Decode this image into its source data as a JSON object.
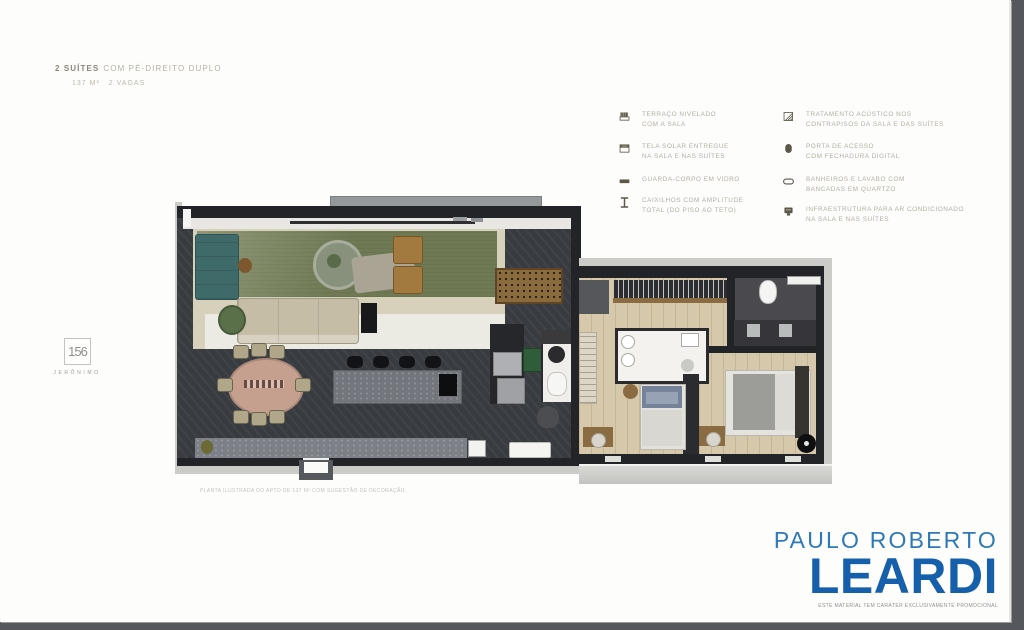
{
  "header": {
    "title_bold": "2 SUÍTES",
    "title_rest": "COM PÉ-DIREITO DUPLO",
    "area": "137 M²",
    "parking": "2 VAGAS"
  },
  "legend": {
    "left": [
      {
        "icon": "terrace-icon",
        "line1": "TERRAÇO NIVELADO",
        "line2": "COM A SALA"
      },
      {
        "icon": "solar-screen-icon",
        "line1": "TELA SOLAR ENTREGUE",
        "line2": "NA SALA E NAS SUÍTES"
      },
      {
        "icon": "glass-railing-icon",
        "line1": "GUARDA-CORPO EM VIDRO",
        "line2": ""
      },
      {
        "icon": "full-height-frame-icon",
        "line1": "CAIXILHOS COM AMPLITUDE",
        "line2": "TOTAL (DO PISO AO TETO)"
      }
    ],
    "right": [
      {
        "icon": "acoustic-floor-icon",
        "line1": "TRATAMENTO ACÚSTICO NOS",
        "line2": "CONTRAPISOS DA SALA E DAS SUÍTES"
      },
      {
        "icon": "digital-lock-icon",
        "line1": "PORTA DE ACESSO",
        "line2": "COM FECHADURA DIGITAL"
      },
      {
        "icon": "quartz-countertop-icon",
        "line1": "BANHEIROS E LAVABO COM",
        "line2": "BANCADAS EM QUARTZO"
      },
      {
        "icon": "air-conditioning-icon",
        "line1": "INFRAESTRUTURA PARA AR CONDICIONADO",
        "line2": "NA SALA E NAS SUÍTES"
      }
    ]
  },
  "building_logo": {
    "number": "156",
    "name": "JERÔNIMO"
  },
  "floorplan": {
    "caption": "PLANTA ILUSTRADA DO APTO DE 137 M² COM SUGESTÃO DE DECORAÇÃO."
  },
  "brand": {
    "line1": "PAULO ROBERTO",
    "line2": "LEARDI",
    "tagline": "ESTE MATERIAL TEM CARÁTER EXCLUSIVAMENTE PROMOCIONAL"
  },
  "colors": {
    "brand_blue": "#1660ab",
    "brand_blue_light": "#2e79b7",
    "legend_text": "#b2aea2",
    "legend_icon": "#5b5848",
    "floor_dark": "#383b40",
    "terrace_green": "#6f7a55",
    "floor_beige": "#d7d1bc",
    "wood_floor": "#d6c8aa",
    "backdrop_gray": "#54575c"
  }
}
